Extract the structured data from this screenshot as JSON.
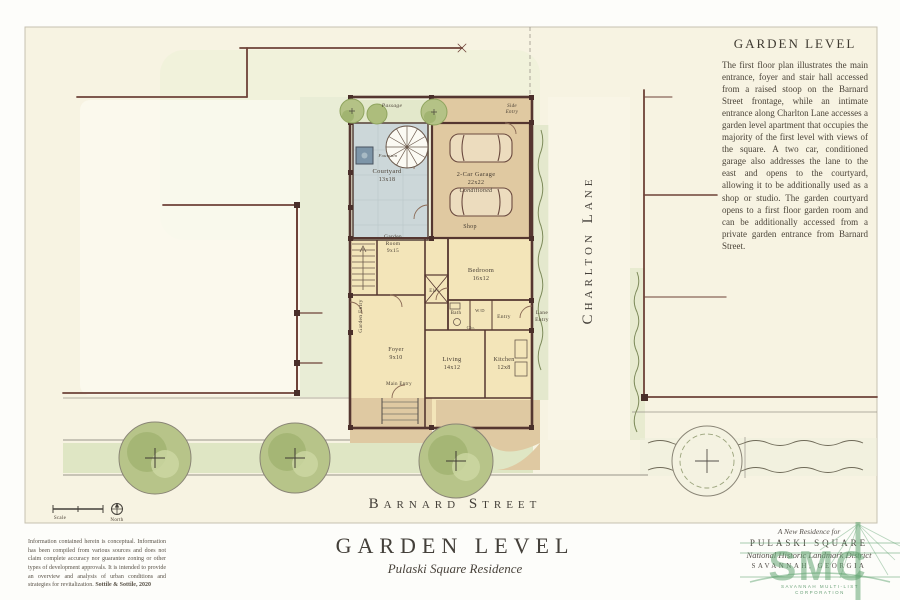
{
  "sheet": {
    "title": "GARDEN LEVEL",
    "subtitle": "Pulaski Square Residence",
    "disclaimer": "Information contained herein is conceptual. Information has been compiled from various sources and does not claim complete accuracy nor guarantee zoning or other types of development approvals. It is intended to provide an overview and analysis of urban conditions and strategies for revitalization. ",
    "disclaimer_credit": "Sottile & Sottile, 2020"
  },
  "note": {
    "title": "GARDEN LEVEL",
    "body": "The first floor plan illustrates the main entrance, foyer and stair hall accessed from a raised stoop on the Barnard Street frontage, while an intimate entrance along Charlton Lane accesses a garden level apartment that occupies the majority of the first level with views of the square. A two car, conditioned garage also addresses the lane to the east and opens to the courtyard, allowing it to be additionally used as a shop or studio. The garden courtyard opens to a first floor garden room and can be additionally accessed from a private garden entrance from Barnard Street."
  },
  "plan": {
    "streets": {
      "east": "Charlton Lane",
      "south": "Barnard Street"
    },
    "labels": [
      {
        "t": "Passage",
        "x": 392,
        "y": 107,
        "s": 5.5,
        "i": true
      },
      {
        "t": "Side",
        "x": 512,
        "y": 107,
        "s": 5,
        "i": true
      },
      {
        "t": "Entry",
        "x": 512,
        "y": 113,
        "s": 5,
        "i": true
      },
      {
        "t": "Fountain",
        "x": 388,
        "y": 157,
        "s": 4.5,
        "i": true
      },
      {
        "t": "Courtyard",
        "x": 387,
        "y": 173,
        "s": 6.5
      },
      {
        "t": "13x18",
        "x": 387,
        "y": 181,
        "s": 6
      },
      {
        "t": "2-Car Garage",
        "x": 476,
        "y": 176,
        "s": 6.5
      },
      {
        "t": "22x22",
        "x": 476,
        "y": 184,
        "s": 6
      },
      {
        "t": "Conditioned",
        "x": 476,
        "y": 192,
        "s": 6,
        "i": true
      },
      {
        "t": "Shop",
        "x": 470,
        "y": 228,
        "s": 6
      },
      {
        "t": "Garden",
        "x": 393,
        "y": 238,
        "s": 5.5
      },
      {
        "t": "Room",
        "x": 393,
        "y": 245,
        "s": 5.5
      },
      {
        "t": "9x15",
        "x": 393,
        "y": 252,
        "s": 5.5
      },
      {
        "t": "Bedroom",
        "x": 481,
        "y": 272,
        "s": 6.5
      },
      {
        "t": "16x12",
        "x": 481,
        "y": 280,
        "s": 6
      },
      {
        "t": "Elev.",
        "x": 435,
        "y": 292,
        "s": 5
      },
      {
        "t": "Bath",
        "x": 456,
        "y": 314,
        "s": 5
      },
      {
        "t": "W/D",
        "x": 480,
        "y": 312,
        "s": 4.5
      },
      {
        "t": "Clo.",
        "x": 471,
        "y": 329,
        "s": 4.5
      },
      {
        "t": "Entry",
        "x": 504,
        "y": 318,
        "s": 5.5
      },
      {
        "t": "Lane",
        "x": 542,
        "y": 314,
        "s": 5.5
      },
      {
        "t": "Entry",
        "x": 542,
        "y": 321,
        "s": 5.5
      },
      {
        "t": "Garden Entry",
        "x": 362,
        "y": 316,
        "s": 5.5,
        "r": -90
      },
      {
        "t": "Foyer",
        "x": 396,
        "y": 351,
        "s": 6
      },
      {
        "t": "9x10",
        "x": 396,
        "y": 359,
        "s": 6
      },
      {
        "t": "Main Entry",
        "x": 399,
        "y": 385,
        "s": 5
      },
      {
        "t": "Living",
        "x": 452,
        "y": 361,
        "s": 6.5
      },
      {
        "t": "14x12",
        "x": 452,
        "y": 369,
        "s": 6
      },
      {
        "t": "Kitchen",
        "x": 504,
        "y": 361,
        "s": 6
      },
      {
        "t": "12x8",
        "x": 504,
        "y": 369,
        "s": 6
      },
      {
        "t": "Scale",
        "x": 60,
        "y": 519,
        "s": 5
      },
      {
        "t": "North",
        "x": 117,
        "y": 521,
        "s": 5
      }
    ]
  },
  "logo": {
    "line1": "A New Residence for",
    "line2": "PULASKI SQUARE",
    "line3": "National Historic Landmark District",
    "line4": "SAVANNAH, GEORGIA"
  },
  "watermark": {
    "text": "SMC",
    "sub1": "SAVANNAH MULTI-LIST",
    "sub2": "CORPORATION"
  },
  "colors": {
    "sheet": "#f7f3e2",
    "wall": "#553630",
    "property_line": "#6e4238",
    "room_fill": "#f3e5b9",
    "drive_tan": "#e0c9a1",
    "courtyard": "#ccd7d9",
    "fountain": "#7d95a8",
    "tree_green": "#b4c286",
    "lawn_green": "#dfe6c4",
    "watermark_green": "#64a573",
    "ink": "#464036"
  }
}
